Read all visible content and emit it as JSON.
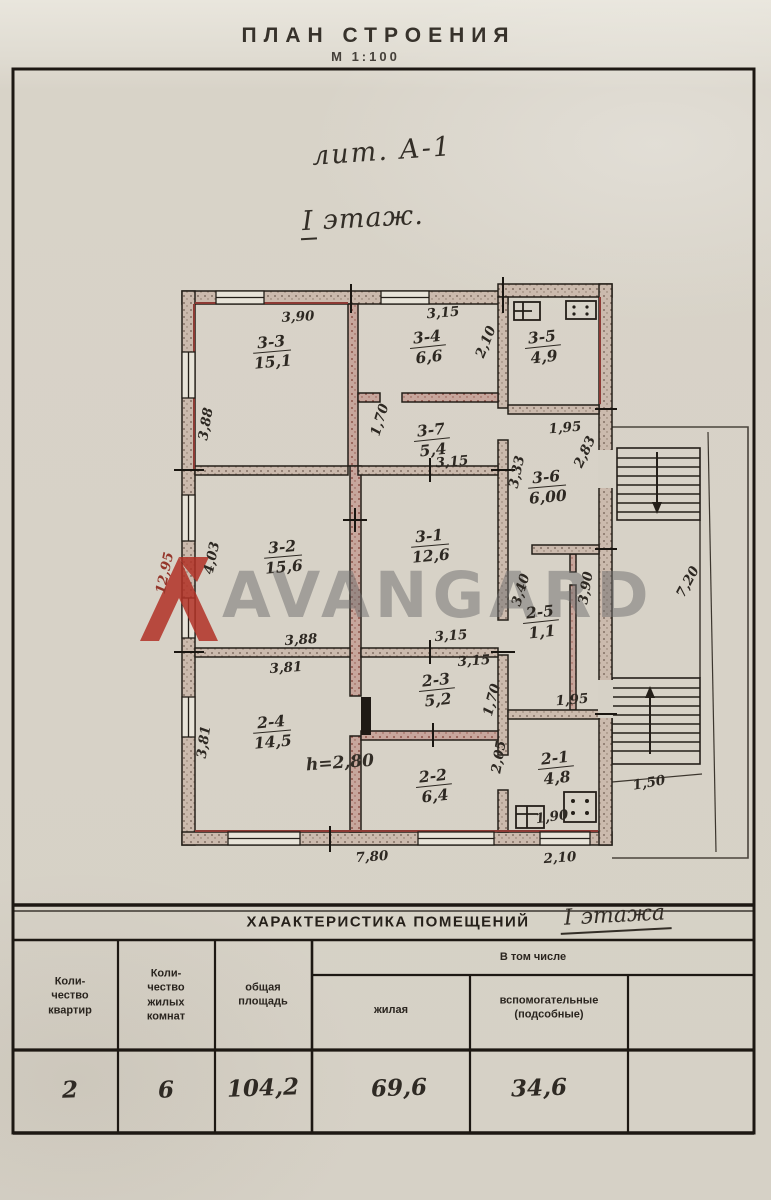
{
  "page": {
    "title": "ПЛАН СТРОЕНИЯ",
    "scale": "М 1:100",
    "liter_note": "лит. А-1",
    "floor_roman": "I",
    "floor_word": "этаж.",
    "height_note": "h=2,80",
    "watermark_text": "AVANGARD",
    "accent_red": "#b23227",
    "ink_color": "#2d2822"
  },
  "plan": {
    "rooms": [
      {
        "id": "3-3",
        "area": "15,1",
        "x": 272,
        "y": 352,
        "rot": -5
      },
      {
        "id": "3-4",
        "area": "6,6",
        "x": 428,
        "y": 347,
        "rot": -6
      },
      {
        "id": "3-5",
        "area": "4,9",
        "x": 543,
        "y": 347,
        "rot": -6
      },
      {
        "id": "3-7",
        "area": "5,4",
        "x": 432,
        "y": 440,
        "rot": -6
      },
      {
        "id": "3-6",
        "area": "6,00",
        "x": 547,
        "y": 487,
        "rot": -5
      },
      {
        "id": "3-2",
        "area": "15,6",
        "x": 283,
        "y": 557,
        "rot": -5
      },
      {
        "id": "3-1",
        "area": "12,6",
        "x": 430,
        "y": 546,
        "rot": -5
      },
      {
        "id": "2-5",
        "area": "1,1",
        "x": 541,
        "y": 622,
        "rot": -6
      },
      {
        "id": "2-4",
        "area": "14,5",
        "x": 272,
        "y": 732,
        "rot": -5
      },
      {
        "id": "2-3",
        "area": "5,2",
        "x": 437,
        "y": 690,
        "rot": -6
      },
      {
        "id": "2-2",
        "area": "6,4",
        "x": 434,
        "y": 786,
        "rot": -6
      },
      {
        "id": "2-1",
        "area": "4,8",
        "x": 556,
        "y": 768,
        "rot": -6
      }
    ],
    "dimensions": [
      {
        "t": "3,90",
        "x": 298,
        "y": 317,
        "rot": -3
      },
      {
        "t": "3,15",
        "x": 443,
        "y": 313,
        "rot": -5
      },
      {
        "t": "3,88",
        "x": 206,
        "y": 424,
        "rot": -80
      },
      {
        "t": "2,10",
        "x": 486,
        "y": 342,
        "rot": -68
      },
      {
        "t": "1,95",
        "x": 565,
        "y": 428,
        "rot": -5
      },
      {
        "t": "1,70",
        "x": 380,
        "y": 420,
        "rot": -73
      },
      {
        "t": "3,15",
        "x": 452,
        "y": 462,
        "rot": -5
      },
      {
        "t": "3,33",
        "x": 517,
        "y": 472,
        "rot": -78
      },
      {
        "t": "2,83",
        "x": 585,
        "y": 452,
        "rot": -65
      },
      {
        "t": "4,03",
        "x": 212,
        "y": 558,
        "rot": -78
      },
      {
        "t": "12,95",
        "x": 165,
        "y": 573,
        "rot": -78,
        "red": true
      },
      {
        "t": "3,88",
        "x": 301,
        "y": 640,
        "rot": -4
      },
      {
        "t": "3,15",
        "x": 451,
        "y": 636,
        "rot": -4
      },
      {
        "t": "3,40",
        "x": 521,
        "y": 590,
        "rot": -73
      },
      {
        "t": "3,90",
        "x": 586,
        "y": 588,
        "rot": -80
      },
      {
        "t": "1,95",
        "x": 572,
        "y": 700,
        "rot": -5
      },
      {
        "t": "3,81",
        "x": 286,
        "y": 668,
        "rot": -4
      },
      {
        "t": "3,81",
        "x": 204,
        "y": 742,
        "rot": -82
      },
      {
        "t": "3,15",
        "x": 474,
        "y": 661,
        "rot": -4
      },
      {
        "t": "1,70",
        "x": 492,
        "y": 700,
        "rot": -75
      },
      {
        "t": "2,05",
        "x": 499,
        "y": 757,
        "rot": -80
      },
      {
        "t": "1,90",
        "x": 552,
        "y": 817,
        "rot": -8
      },
      {
        "t": "2,10",
        "x": 560,
        "y": 858,
        "rot": -4
      },
      {
        "t": "7,80",
        "x": 372,
        "y": 857,
        "rot": -4
      },
      {
        "t": "7,20",
        "x": 688,
        "y": 582,
        "rot": -62
      },
      {
        "t": "1,50",
        "x": 649,
        "y": 783,
        "rot": -10
      }
    ],
    "symbols": [
      "furnace-icon",
      "gas-stove-icon",
      "stairs-down-arrow",
      "stairs-up-arrow"
    ]
  },
  "table": {
    "title": "ХАРАКТЕРИСТИКА ПОМЕЩЕНИЙ",
    "suffix_roman": "I",
    "suffix_word": "этажа",
    "group_header": "В том числе",
    "columns": [
      "Коли-\nчество\nквартир",
      "Коли-\nчество\nжилых\nкомнат",
      "общая\nплощадь",
      "жилая",
      "вспомогательные\n(подсобные)",
      ""
    ],
    "row": [
      "2",
      "6",
      "104,2",
      "69,6",
      "34,6",
      ""
    ]
  }
}
